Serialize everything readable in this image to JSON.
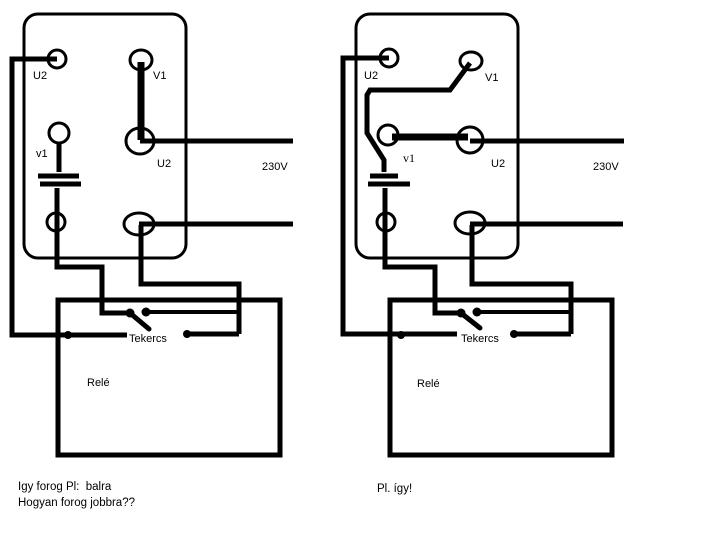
{
  "colors": {
    "background": "#ffffff",
    "ink": "#000000"
  },
  "left_diagram": {
    "terminals": {
      "top_left": "U2",
      "top_right": "V1",
      "mid_left": "v1",
      "mid_right": "U2"
    },
    "supply_label": "230V",
    "relay": {
      "coil_label": "Tekercs",
      "name_label": "Relé"
    }
  },
  "right_diagram": {
    "terminals": {
      "top_left": "U2",
      "top_right": "V1",
      "mid_left": "v1",
      "mid_right": "U2"
    },
    "supply_label": "230V",
    "relay": {
      "coil_label": "Tekercs",
      "name_label": "Relé"
    }
  },
  "captions": {
    "left_line1": "Igy forog Pl:  balra",
    "left_line2": "Hogyan forog jobbra??",
    "right_line1": "Pl. így!"
  }
}
